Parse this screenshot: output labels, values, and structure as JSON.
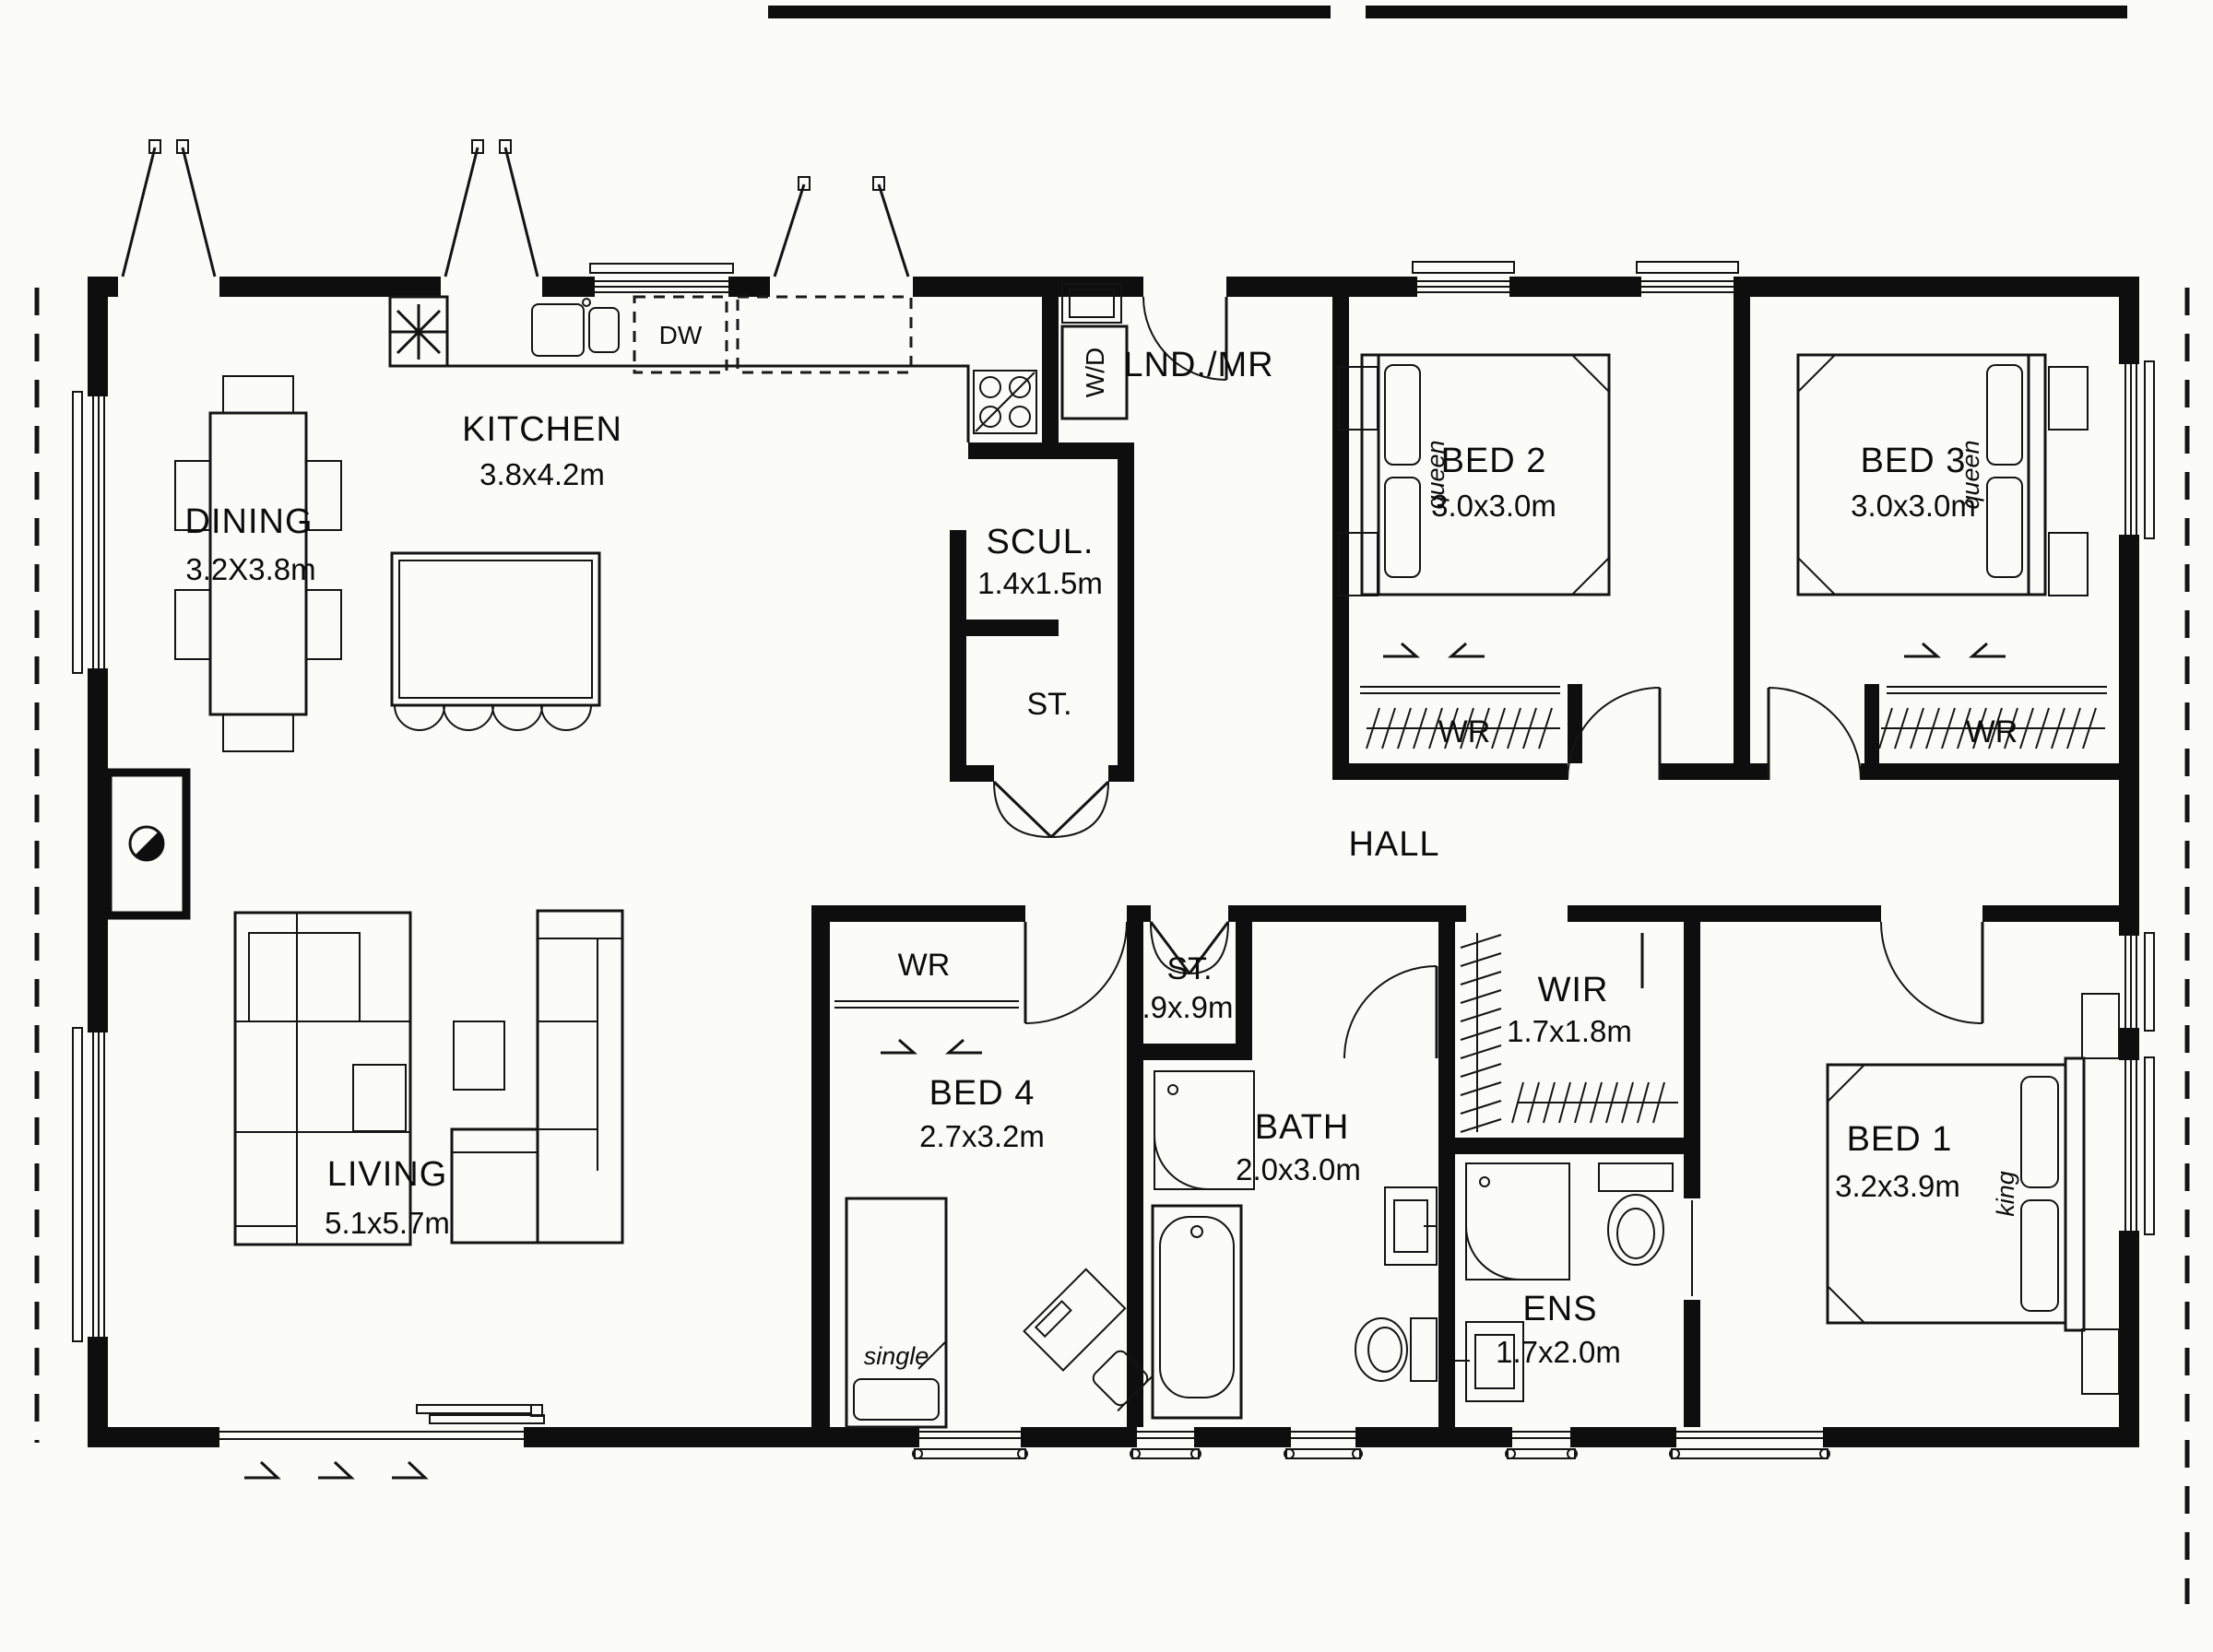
{
  "plan": {
    "rooms": {
      "dining": {
        "name": "DINING",
        "dims": "3.2X3.8m"
      },
      "kitchen": {
        "name": "KITCHEN",
        "dims": "3.8x4.2m"
      },
      "scullery": {
        "name": "SCUL.",
        "dims": "1.4x1.5m"
      },
      "store_upper": {
        "name": "ST."
      },
      "laundry": {
        "name": "LND./MR"
      },
      "bed2": {
        "name": "BED 2",
        "dims": "3.0x3.0m",
        "bed_type": "queen",
        "wardrobe": "WR"
      },
      "bed3": {
        "name": "BED 3",
        "dims": "3.0x3.0m",
        "bed_type": "queen",
        "wardrobe": "WR"
      },
      "hall": {
        "name": "HALL"
      },
      "living": {
        "name": "LIVING",
        "dims": "5.1x5.7m"
      },
      "bed4": {
        "name": "BED 4",
        "dims": "2.7x3.2m",
        "bed_type": "single",
        "wardrobe": "WR"
      },
      "store_lower": {
        "name": "ST.",
        "dims": ".9x.9m"
      },
      "bath": {
        "name": "BATH",
        "dims": "2.0x3.0m"
      },
      "wir": {
        "name": "WIR",
        "dims": "1.7x1.8m"
      },
      "ens": {
        "name": "ENS",
        "dims": "1.7x2.0m"
      },
      "bed1": {
        "name": "BED 1",
        "dims": "3.2x3.9m",
        "bed_type": "king"
      }
    },
    "appliances": {
      "dishwasher": "DW",
      "washer_dryer": "W/D"
    },
    "colors": {
      "wall": "#0e0e0e",
      "background": "#fbfbf8",
      "text": "#0c0c0c"
    }
  }
}
